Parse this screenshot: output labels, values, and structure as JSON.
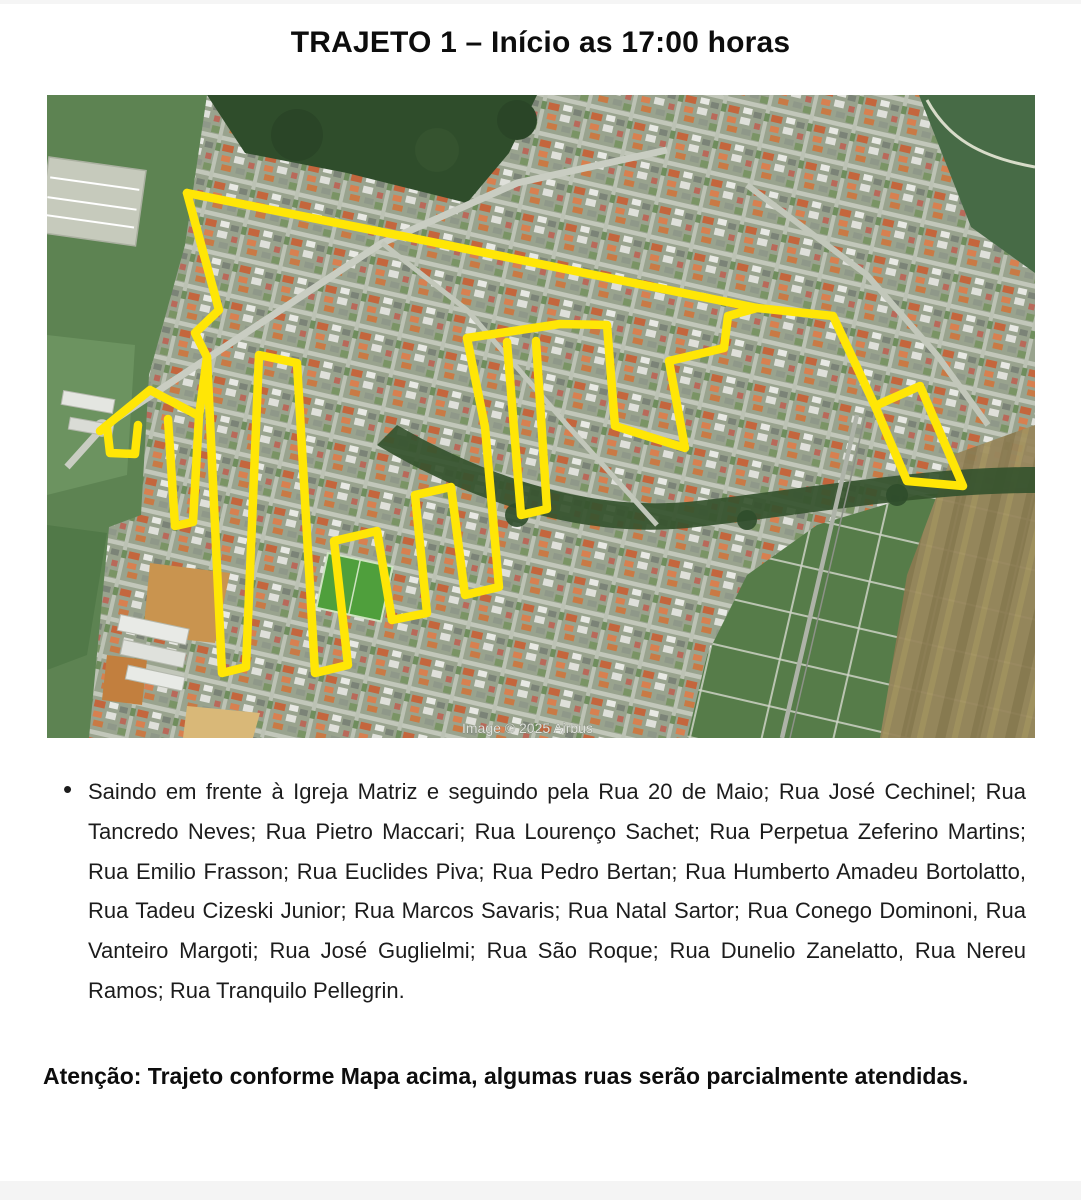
{
  "page": {
    "title": "TRAJETO 1 – Início as 17:00 horas",
    "bullet": "•",
    "route_description": "Saindo em frente à Igreja Matriz e seguindo pela Rua 20 de Maio; Rua José Cechinel; Rua Tancredo Neves; Rua Pietro Maccari; Rua Lourenço Sachet; Rua Perpetua Zeferino Martins; Rua Emilio Frasson; Rua Euclides Piva; Rua Pedro Bertan; Rua Humberto Amadeu Bortolatto, Rua Tadeu Cizeski Junior; Rua Marcos Savaris; Rua Natal Sartor; Rua Conego Dominoni, Rua Vanteiro Margoti; Rua José Guglielmi; Rua São Roque; Rua Dunelio Zanelatto, Rua Nereu Ramos; Rua Tranquilo Pellegrin.",
    "attention": "Atenção: Trajeto conforme Mapa acima, algumas ruas serão parcialmente atendidas.",
    "map": {
      "type": "satellite",
      "attribution": "Image © 2025 Airbus",
      "route_color": "#FFE606",
      "route_paths": [
        "M140,98 L380,146 L710,213 L786,221 L828,311 L873,291 L916,391 L860,386 L828,311",
        "M140,98 L172,215 L148,238 L160,262 L175,578 L199,572 L212,260 L250,268 L268,578 L301,570 L287,446 L330,436 L345,525 L380,518 L368,400 L404,392 L418,500 L452,492 L438,332 L420,243",
        "M710,213 L681,221 L677,253 L622,266 L638,353 L568,331 L560,230 L513,229 L420,243",
        "M460,247 L474,420 L500,414 L489,246",
        "M53,336 L103,295 L152,321 L160,262",
        "M60,332 L63,358 L88,359 L91,330",
        "M121,324 L128,431 L146,427 L152,321"
      ]
    }
  }
}
